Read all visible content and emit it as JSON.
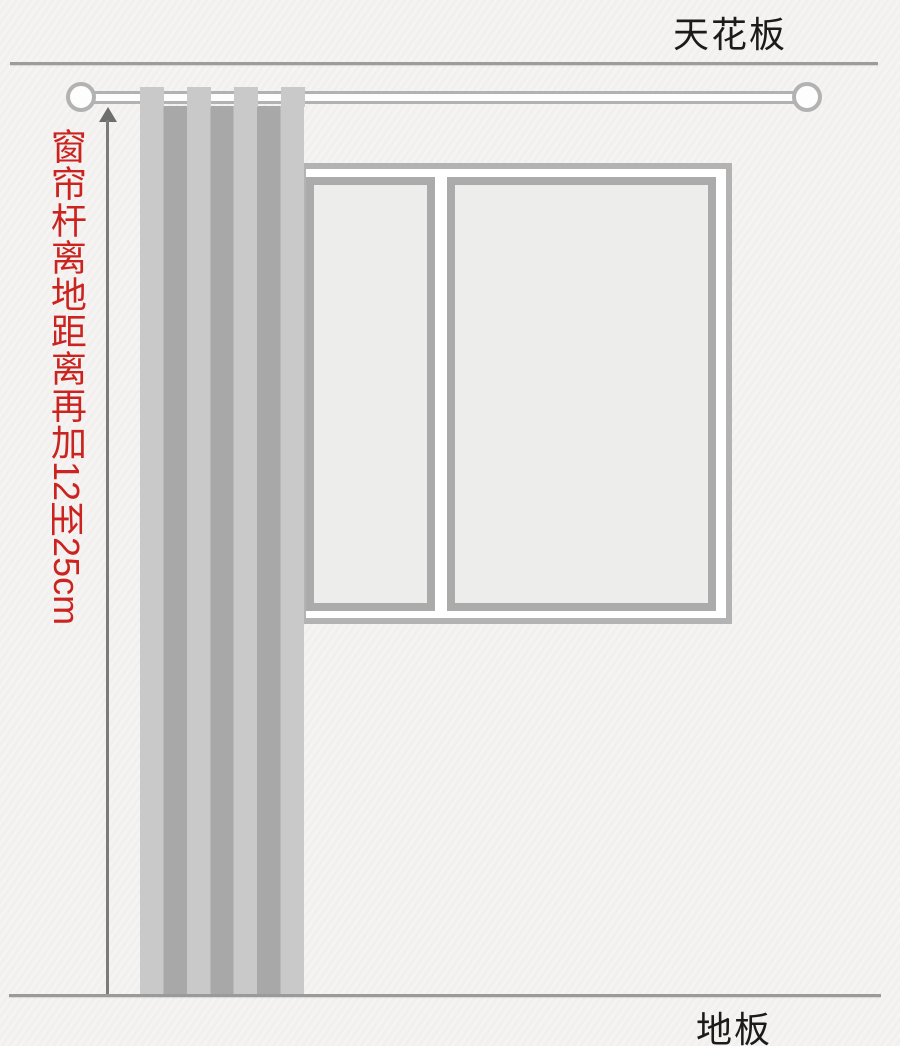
{
  "diagram": {
    "type": "curtain-rod-installation-guide",
    "labels": {
      "ceiling": "天花板",
      "floor": "地板",
      "measurement": {
        "cjk": "窗帘杆离地距离再加",
        "suffix": "12至25cm",
        "full": "窗帘杆离地距离再加12至25cm"
      }
    },
    "elements": {
      "curtain_rod": "horizontal rod with round finials below ceiling line",
      "curtain": "striped curtain hanging from rod to floor",
      "window": "two-pane window partially covered by curtain",
      "measurement_arrow": "vertical arrow from rod down to floor"
    },
    "colors": {
      "background": "#f5f4f2",
      "structure_line": "#9c9c9c",
      "label_text": "#1b1b1b",
      "measurement_text": "#cb2420",
      "curtain_light": "#c9c9c9",
      "curtain_dark": "#a8a8a8",
      "window_frame": "#b3b3b3",
      "pane_border": "#ababab",
      "pane_fill": "#ededeb",
      "rod": "#b2b2b2",
      "arrow": "#6e6e6e"
    }
  }
}
